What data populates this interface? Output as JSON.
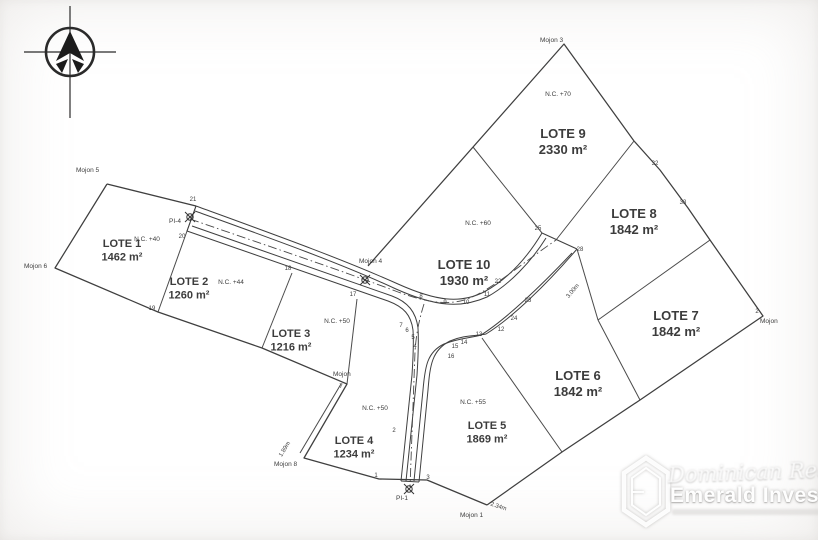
{
  "compass": {
    "icon": "north-compass-icon"
  },
  "ink_color": "#3f3f3f",
  "lots": [
    {
      "name": "LOTE 1",
      "area": "1462 m²",
      "nc": "N.C. +40",
      "x": 122,
      "y": 247,
      "ncx": 147,
      "ncy": 241,
      "size": 11
    },
    {
      "name": "LOTE 2",
      "area": "1260 m²",
      "nc": "N.C. +44",
      "x": 189,
      "y": 285,
      "ncx": 231,
      "ncy": 284,
      "size": 11
    },
    {
      "name": "LOTE 3",
      "area": "1216 m²",
      "nc": "N.C. +50",
      "x": 291,
      "y": 337,
      "ncx": 337,
      "ncy": 323,
      "size": 11
    },
    {
      "name": "LOTE 4",
      "area": "1234 m²",
      "nc": "N.C. +50",
      "x": 354,
      "y": 444,
      "ncx": 375,
      "ncy": 410,
      "size": 11
    },
    {
      "name": "LOTE 5",
      "area": "1869 m²",
      "nc": "N.C. +55",
      "x": 487,
      "y": 429,
      "ncx": 473,
      "ncy": 404,
      "size": 11
    },
    {
      "name": "LOTE 6",
      "area": "1842 m²",
      "x": 578,
      "y": 380,
      "size": 13
    },
    {
      "name": "LOTE 7",
      "area": "1842 m²",
      "x": 676,
      "y": 320,
      "size": 13
    },
    {
      "name": "LOTE 8",
      "area": "1842 m²",
      "x": 634,
      "y": 218,
      "size": 13
    },
    {
      "name": "LOTE 9",
      "area": "2330 m²",
      "nc": "N.C. +70",
      "x": 563,
      "y": 138,
      "ncx": 558,
      "ncy": 96,
      "size": 13
    },
    {
      "name": "LOTE 10",
      "area": "1930 m²",
      "nc": "N.C. +60",
      "x": 464,
      "y": 269,
      "ncx": 478,
      "ncy": 225,
      "size": 13
    }
  ],
  "vertices": [
    {
      "n": "21",
      "x": 193,
      "y": 201
    },
    {
      "n": "20",
      "x": 182,
      "y": 238
    },
    {
      "n": "19",
      "x": 152,
      "y": 310
    },
    {
      "n": "18",
      "x": 288,
      "y": 270
    },
    {
      "n": "17",
      "x": 353,
      "y": 296
    },
    {
      "n": "8",
      "x": 421,
      "y": 298
    },
    {
      "n": "9",
      "x": 445,
      "y": 304
    },
    {
      "n": "10",
      "x": 466,
      "y": 304
    },
    {
      "n": "11",
      "x": 487,
      "y": 296
    },
    {
      "n": "22",
      "x": 498,
      "y": 283
    },
    {
      "n": "7",
      "x": 401,
      "y": 327
    },
    {
      "n": "6",
      "x": 407,
      "y": 332
    },
    {
      "n": "5",
      "x": 413,
      "y": 339
    },
    {
      "n": "4",
      "x": 415,
      "y": 348
    },
    {
      "n": "16",
      "x": 451,
      "y": 358
    },
    {
      "n": "15",
      "x": 455,
      "y": 348
    },
    {
      "n": "14",
      "x": 464,
      "y": 344
    },
    {
      "n": "13",
      "x": 479,
      "y": 336
    },
    {
      "n": "12",
      "x": 501,
      "y": 331
    },
    {
      "n": "24",
      "x": 514,
      "y": 320
    },
    {
      "n": "23",
      "x": 528,
      "y": 302
    },
    {
      "n": "25",
      "x": 538,
      "y": 230
    },
    {
      "n": "28",
      "x": 580,
      "y": 251
    },
    {
      "n": "32",
      "x": 655,
      "y": 165
    },
    {
      "n": "33",
      "x": 683,
      "y": 204
    },
    {
      "n": "2",
      "x": 394,
      "y": 432
    },
    {
      "n": "1",
      "x": 376,
      "y": 477
    },
    {
      "n": "3",
      "x": 428,
      "y": 479
    },
    {
      "n": "2",
      "x": 757,
      "y": 313
    },
    {
      "n": "7",
      "x": 341,
      "y": 388
    }
  ],
  "mojones": [
    {
      "label": "Mojon 5",
      "x": 76,
      "y": 172
    },
    {
      "label": "Mojon 6",
      "x": 24,
      "y": 268
    },
    {
      "label": "Mojon 4",
      "x": 359,
      "y": 263
    },
    {
      "label": "Mojon 3",
      "x": 540,
      "y": 42
    },
    {
      "label": "Mojon",
      "x": 760,
      "y": 323
    },
    {
      "label": "Mojon",
      "x": 333,
      "y": 376
    },
    {
      "label": "Mojon 8",
      "x": 274,
      "y": 466
    },
    {
      "label": "Mojon 1",
      "x": 460,
      "y": 517
    }
  ],
  "pi_markers": [
    {
      "label": "PI-4",
      "lx": 175,
      "ly": 223,
      "cx": 190,
      "cy": 217
    },
    {
      "label": "",
      "lx": 0,
      "ly": 0,
      "cx": 365,
      "cy": 280
    },
    {
      "label": "PI-1",
      "lx": 402,
      "ly": 500,
      "cx": 409,
      "cy": 489
    }
  ],
  "dimensions": [
    {
      "label": "1.89m",
      "x": 286,
      "y": 450,
      "rotate": -58
    },
    {
      "label": "2.34m",
      "x": 498,
      "y": 508,
      "rotate": 18
    },
    {
      "label": "3.00m",
      "x": 574,
      "y": 292,
      "rotate": -50
    }
  ],
  "watermark": {
    "script_line": "Dominican Real Estate",
    "brand": "Emerald Investments",
    "logo": "hexagon-logo",
    "color": "#ffffff"
  }
}
